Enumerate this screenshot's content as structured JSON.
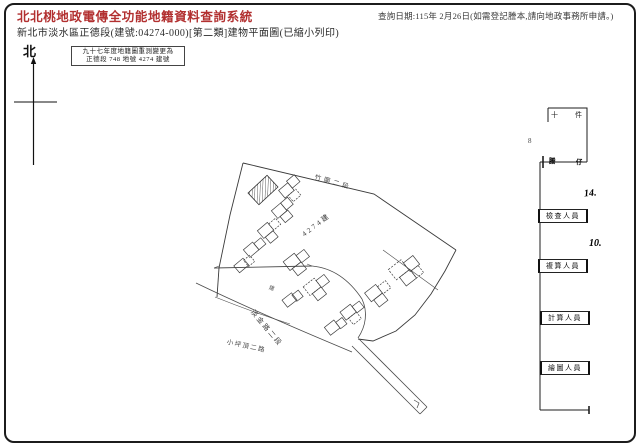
{
  "header": {
    "system_title": "北北桃地政電傳全功能地籍資料查詢系統",
    "document_title": "新北市淡水區正德段(建號:04274-000)[第二類]建物平面圖(已縮小列印)",
    "query_date": "查詢日期:115年 2月26日(如需登記謄本,請向地政事務所申請。)"
  },
  "plan": {
    "north_label": "北",
    "survey_note_line1": "九十七年度地籍圖重測變更為",
    "survey_note_line2": "正德段 748 地號 4274 建號",
    "building_label": "4274建",
    "road_label_top": "竹圍二段",
    "road_label_left": "淡金路二段",
    "road_label_bottom": "小坪頂二路",
    "small_mark": "建"
  },
  "margin_form": {
    "box_char_left": "十",
    "box_char_right": "件",
    "stamp_left": "謄",
    "stamp_right": "仔",
    "hand_number_1": "14.",
    "hand_number_2": "10.",
    "side_mark": "8",
    "sig_box_1": "檢查人員",
    "sig_box_2": "複算人員",
    "sig_box_3": "計算人員",
    "sig_box_4": "繪圖人員"
  },
  "colors": {
    "title_red": "#b23030",
    "ink": "#222222",
    "line": "#3a3a3a"
  }
}
